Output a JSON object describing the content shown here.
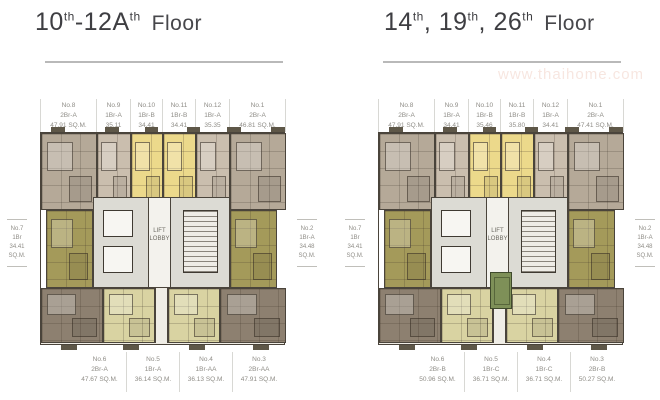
{
  "watermark": "www.thaihome.com",
  "core": {
    "line1": "LIFT",
    "line2": "LOBBY"
  },
  "colors": {
    "tan": "#b5a998",
    "tanlight": "#cabeae",
    "yellow": "#ecd98b",
    "olive": "#a49a5a",
    "brown": "#8d8070",
    "pale": "#d9d3a2",
    "green": "#7e9058",
    "core": "#dcdbd4",
    "wall": "#4a443b"
  },
  "plans": [
    {
      "title": {
        "p1": "10",
        "s1": "th",
        "p2": "-12A",
        "s2": "th",
        "p3": "",
        "s3": "",
        "rest": "Floor"
      },
      "has_green_unit": false,
      "top_units": [
        {
          "no": "No.8",
          "type": "2Br-A",
          "area": "47.91 SQ.M."
        },
        {
          "no": "No.9",
          "type": "1Br-A",
          "area": "35.11 SQ.M."
        },
        {
          "no": "No.10",
          "type": "1Br-B",
          "area": "34.41 SQ.M."
        },
        {
          "no": "No.11",
          "type": "1Br-B",
          "area": "34.41 SQ.M."
        },
        {
          "no": "No.12",
          "type": "1Br-A",
          "area": "35.35 SQ.M."
        },
        {
          "no": "No.1",
          "type": "2Br-A",
          "area": "46.81 SQ.M."
        }
      ],
      "bottom_units": [
        {
          "no": "No.6",
          "type": "2Br-A",
          "area": "47.67 SQ.M."
        },
        {
          "no": "No.5",
          "type": "1Br-A",
          "area": "36.14 SQ.M."
        },
        {
          "no": "No.4",
          "type": "1Br-AA",
          "area": "36.13 SQ.M."
        },
        {
          "no": "No.3",
          "type": "2Br-AA",
          "area": "47.91 SQ.M."
        }
      ],
      "left_unit": {
        "no": "No.7",
        "type": "1Br",
        "area": "34.41 SQ.M."
      },
      "right_unit": {
        "no": "No.2",
        "type": "1Br-A",
        "area": "34.48 SQ.M."
      }
    },
    {
      "title": {
        "p1": "14",
        "s1": "th",
        "p2": ", 19",
        "s2": "th",
        "p3": ", 26",
        "s3": "th",
        "rest": "Floor"
      },
      "has_green_unit": true,
      "top_units": [
        {
          "no": "No.8",
          "type": "2Br-A",
          "area": "47.91 SQ.M."
        },
        {
          "no": "No.9",
          "type": "1Br-A",
          "area": "34.41 SQ.M."
        },
        {
          "no": "No.10",
          "type": "1Br-B",
          "area": "35.46 SQ.M."
        },
        {
          "no": "No.11",
          "type": "1Br-B",
          "area": "35.80 SQ.M."
        },
        {
          "no": "No.12",
          "type": "1Br-A",
          "area": "34.41 SQ.M."
        },
        {
          "no": "No.1",
          "type": "2Br-A",
          "area": "47.41 SQ.M."
        }
      ],
      "bottom_units": [
        {
          "no": "No.6",
          "type": "2Br-B",
          "area": "50.96 SQ.M."
        },
        {
          "no": "No.5",
          "type": "1Br-C",
          "area": "36.71 SQ.M."
        },
        {
          "no": "No.4",
          "type": "1Br-C",
          "area": "36.71 SQ.M."
        },
        {
          "no": "No.3",
          "type": "2Br-B",
          "area": "50.27 SQ.M."
        }
      ],
      "left_unit": {
        "no": "No.7",
        "type": "1Br",
        "area": "34.41 SQ.M."
      },
      "right_unit": {
        "no": "No.2",
        "type": "1Br-A",
        "area": "34.48 SQ.M."
      }
    }
  ]
}
